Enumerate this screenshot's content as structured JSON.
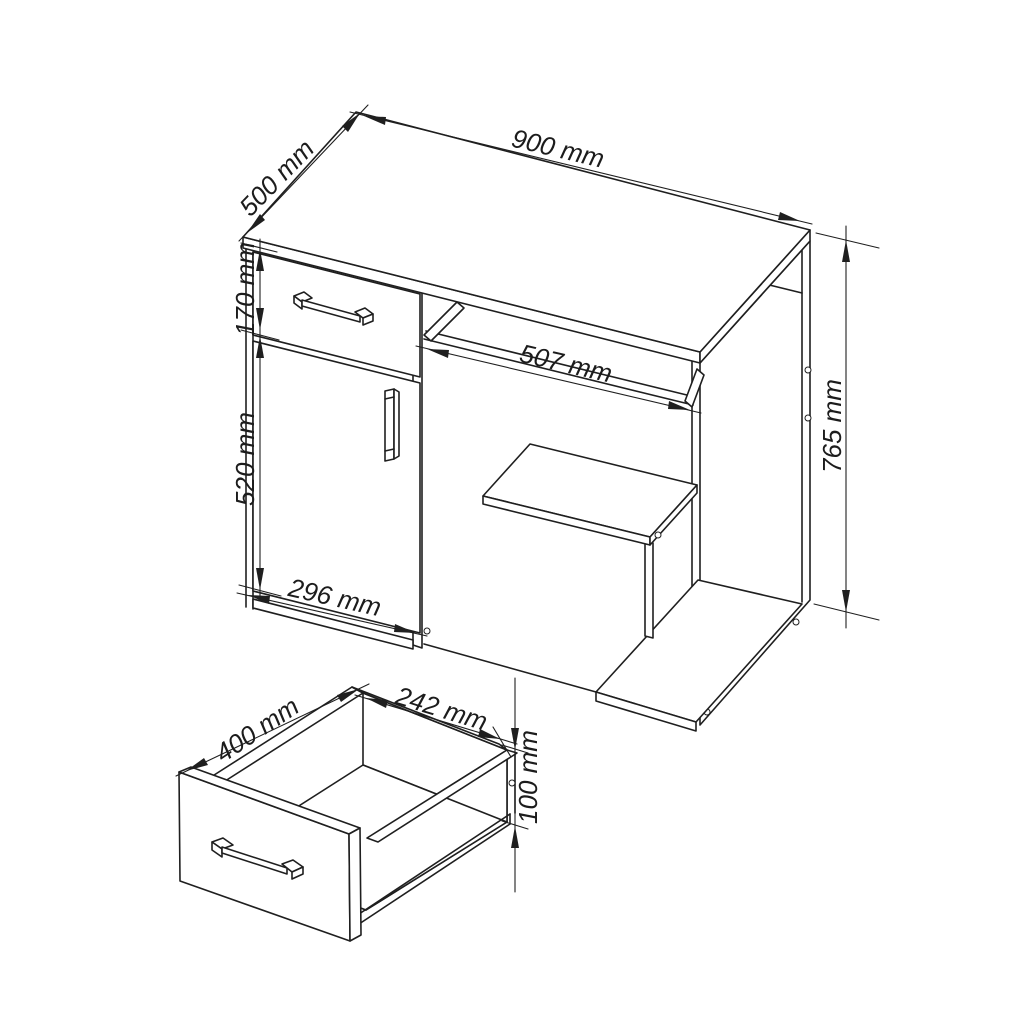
{
  "drawing": {
    "background": "#ffffff",
    "line_color": "#1f1f1f",
    "views": {
      "desk": {
        "dims": {
          "width": "900 mm",
          "depth": "500 mm",
          "drawer_front_height": "170 mm",
          "door_height": "520 mm",
          "door_width": "296 mm",
          "keyboard_tray_width": "507 mm",
          "overall_height": "765 mm"
        }
      },
      "drawer": {
        "dims": {
          "depth": "400 mm",
          "inner_width": "242 mm",
          "height": "100 mm"
        }
      }
    }
  }
}
